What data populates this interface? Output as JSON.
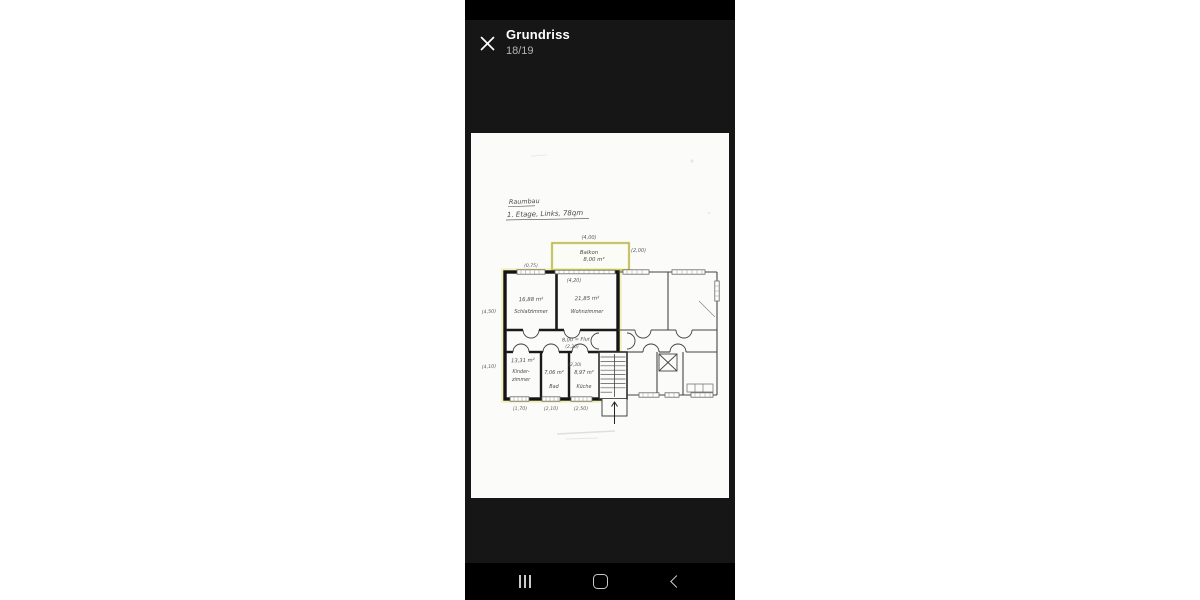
{
  "header": {
    "title": "Grundriss",
    "counter": "18/19",
    "close_icon": "✕"
  },
  "plan": {
    "note_line1": "Raumbau",
    "note_line2": "1. Etage, Links, 78qm",
    "balcony": {
      "name": "Balkon",
      "area": "8,00 m²"
    },
    "flur": {
      "label": "8,00 = Flur",
      "dim": "(2,20)"
    },
    "rooms": {
      "schlafzimmer": {
        "area": "16,88 m²",
        "name": "Schlafzimmer"
      },
      "wohnzimmer": {
        "area": "21,85 m²",
        "name": "Wohnzimmer"
      },
      "kinderzimmer": {
        "area": "13,31 m²",
        "name1": "Kinder-",
        "name2": "zimmer"
      },
      "bad": {
        "area": "7,06 m²",
        "name": "Bad"
      },
      "kueche": {
        "area": "8,97 m²",
        "name": "Küche",
        "dim": "(2,30)"
      }
    },
    "dims": {
      "balcony_top": "(4,00)",
      "balcony_right": "(2,00)",
      "under_balcony": "(4,20)",
      "top_window": "(0,75)",
      "left_upper": "(4,50)",
      "left_lower": "(4,10)",
      "bottom_left": "(1,70)",
      "bottom_mid": "(2,10)",
      "bottom_right": "(2,50)"
    },
    "colors": {
      "highlight": "#e3dc55",
      "ink": "#161616",
      "pencil": "#4a4a4a",
      "paper": "#fbfbf9"
    }
  },
  "nav": {
    "recents": "recents",
    "home": "home",
    "back": "back"
  }
}
